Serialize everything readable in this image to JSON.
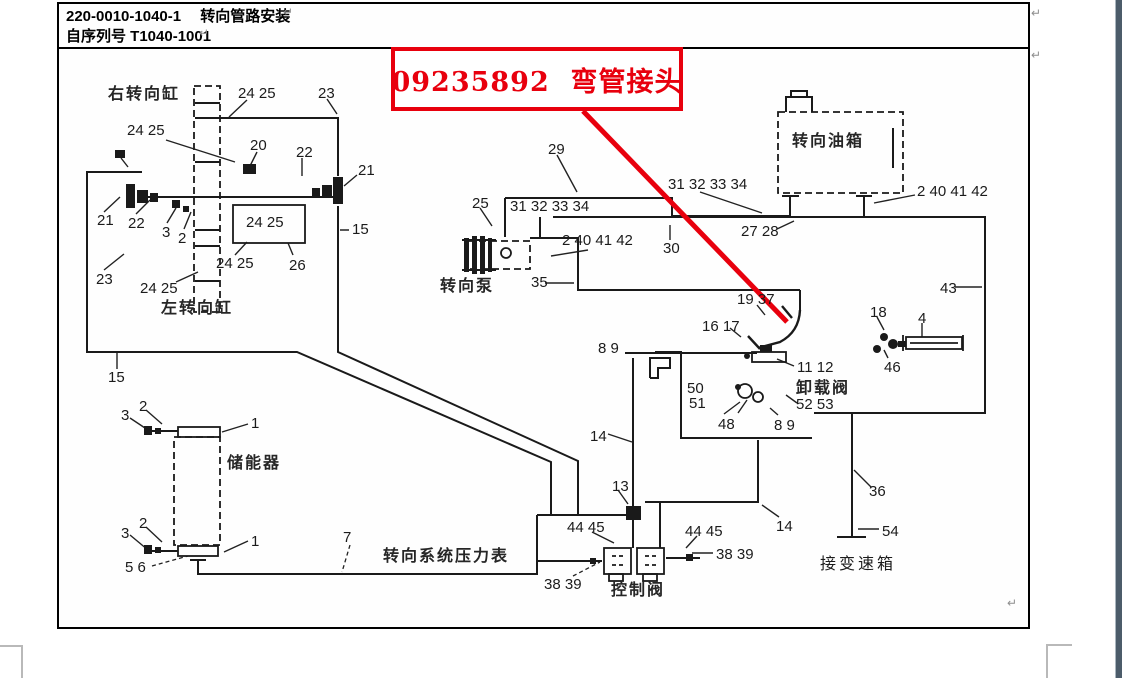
{
  "page": {
    "header": {
      "line1": "220-0010-1040-1　 转向管路安装",
      "line2": "自序列号 T1040-1001"
    },
    "callout": {
      "text": "09235892  弯管接头",
      "color": "#e8000d"
    },
    "pilcrow_char": "↵",
    "pilcrows": [
      {
        "x": 283,
        "y": 5
      },
      {
        "x": 199,
        "y": 26
      },
      {
        "x": 1031,
        "y": 6
      },
      {
        "x": 1031,
        "y": 48
      },
      {
        "x": 1007,
        "y": 596
      }
    ],
    "colors": {
      "accent_red": "#e8000d",
      "line_black": "#1a1a1a",
      "boundary_gray": "#b9b9b9"
    }
  },
  "diagram": {
    "component_labels": [
      {
        "text": "右转向缸",
        "x": 108,
        "y": 80,
        "name": "label-right-steering-cylinder"
      },
      {
        "text": "左转向缸",
        "x": 161,
        "y": 294,
        "name": "label-left-steering-cylinder"
      },
      {
        "text": "转向泵",
        "x": 440,
        "y": 272,
        "name": "label-steering-pump"
      },
      {
        "text": "转向油箱",
        "x": 792,
        "y": 127,
        "name": "label-steering-oil-tank"
      },
      {
        "text": "卸载阀",
        "x": 796,
        "y": 374,
        "name": "label-unloading-valve"
      },
      {
        "text": "储能器",
        "x": 227,
        "y": 449,
        "name": "label-accumulator"
      },
      {
        "text": "转向系统压力表",
        "x": 383,
        "y": 542,
        "name": "label-steering-system-pressure-gauge"
      },
      {
        "text": "控制阀",
        "x": 611,
        "y": 576,
        "name": "label-control-valve"
      },
      {
        "text": "接变速箱",
        "x": 820,
        "y": 550,
        "bold": false,
        "name": "label-to-gearbox"
      }
    ],
    "part_numbers": [
      {
        "text": "24 25",
        "x": 238,
        "y": 85
      },
      {
        "text": "23",
        "x": 318,
        "y": 85
      },
      {
        "text": "24 25",
        "x": 127,
        "y": 122
      },
      {
        "text": "20",
        "x": 250,
        "y": 137
      },
      {
        "text": "22",
        "x": 296,
        "y": 144
      },
      {
        "text": "21",
        "x": 358,
        "y": 162
      },
      {
        "text": "21",
        "x": 97,
        "y": 212
      },
      {
        "text": "22",
        "x": 128,
        "y": 215
      },
      {
        "text": "3",
        "x": 162,
        "y": 224
      },
      {
        "text": "2",
        "x": 178,
        "y": 230
      },
      {
        "text": "24 25",
        "x": 246,
        "y": 214
      },
      {
        "text": "15",
        "x": 352,
        "y": 221
      },
      {
        "text": "26",
        "x": 289,
        "y": 257
      },
      {
        "text": "24 25",
        "x": 216,
        "y": 255
      },
      {
        "text": "23",
        "x": 96,
        "y": 271
      },
      {
        "text": "24 25",
        "x": 140,
        "y": 280
      },
      {
        "text": "15",
        "x": 108,
        "y": 369
      },
      {
        "text": "29",
        "x": 548,
        "y": 141
      },
      {
        "text": "25",
        "x": 472,
        "y": 195
      },
      {
        "text": "31 32 33 34",
        "x": 510,
        "y": 198
      },
      {
        "text": "2 40 41 42",
        "x": 562,
        "y": 232
      },
      {
        "text": "30",
        "x": 663,
        "y": 240
      },
      {
        "text": "35",
        "x": 531,
        "y": 274
      },
      {
        "text": "31 32 33 34",
        "x": 668,
        "y": 176
      },
      {
        "text": "27 28",
        "x": 741,
        "y": 223
      },
      {
        "text": "2 40 41 42",
        "x": 917,
        "y": 183
      },
      {
        "text": "43",
        "x": 940,
        "y": 280
      },
      {
        "text": "19 37",
        "x": 737,
        "y": 291
      },
      {
        "text": "16 17",
        "x": 702,
        "y": 318
      },
      {
        "text": "18",
        "x": 870,
        "y": 304
      },
      {
        "text": "4",
        "x": 918,
        "y": 310
      },
      {
        "text": "46",
        "x": 884,
        "y": 359
      },
      {
        "text": "8 9",
        "x": 598,
        "y": 340
      },
      {
        "text": "11 12",
        "x": 797,
        "y": 359
      },
      {
        "text": "50",
        "x": 687,
        "y": 380
      },
      {
        "text": "51",
        "x": 689,
        "y": 395
      },
      {
        "text": "52 53",
        "x": 796,
        "y": 396
      },
      {
        "text": "48",
        "x": 718,
        "y": 416
      },
      {
        "text": "8 9",
        "x": 774,
        "y": 417
      },
      {
        "text": "14",
        "x": 590,
        "y": 428
      },
      {
        "text": "2",
        "x": 139,
        "y": 398
      },
      {
        "text": "3",
        "x": 121,
        "y": 407
      },
      {
        "text": "1",
        "x": 251,
        "y": 415
      },
      {
        "text": "2",
        "x": 139,
        "y": 515
      },
      {
        "text": "3",
        "x": 121,
        "y": 525
      },
      {
        "text": "1",
        "x": 251,
        "y": 533
      },
      {
        "text": "5 6",
        "x": 125,
        "y": 559
      },
      {
        "text": "7",
        "x": 343,
        "y": 529
      },
      {
        "text": "13",
        "x": 612,
        "y": 478
      },
      {
        "text": "44 45",
        "x": 567,
        "y": 519
      },
      {
        "text": "44 45",
        "x": 685,
        "y": 523
      },
      {
        "text": "38 39",
        "x": 544,
        "y": 576
      },
      {
        "text": "38 39",
        "x": 716,
        "y": 546
      },
      {
        "text": "14",
        "x": 776,
        "y": 518
      },
      {
        "text": "36",
        "x": 869,
        "y": 483
      },
      {
        "text": "54",
        "x": 882,
        "y": 523
      }
    ]
  }
}
